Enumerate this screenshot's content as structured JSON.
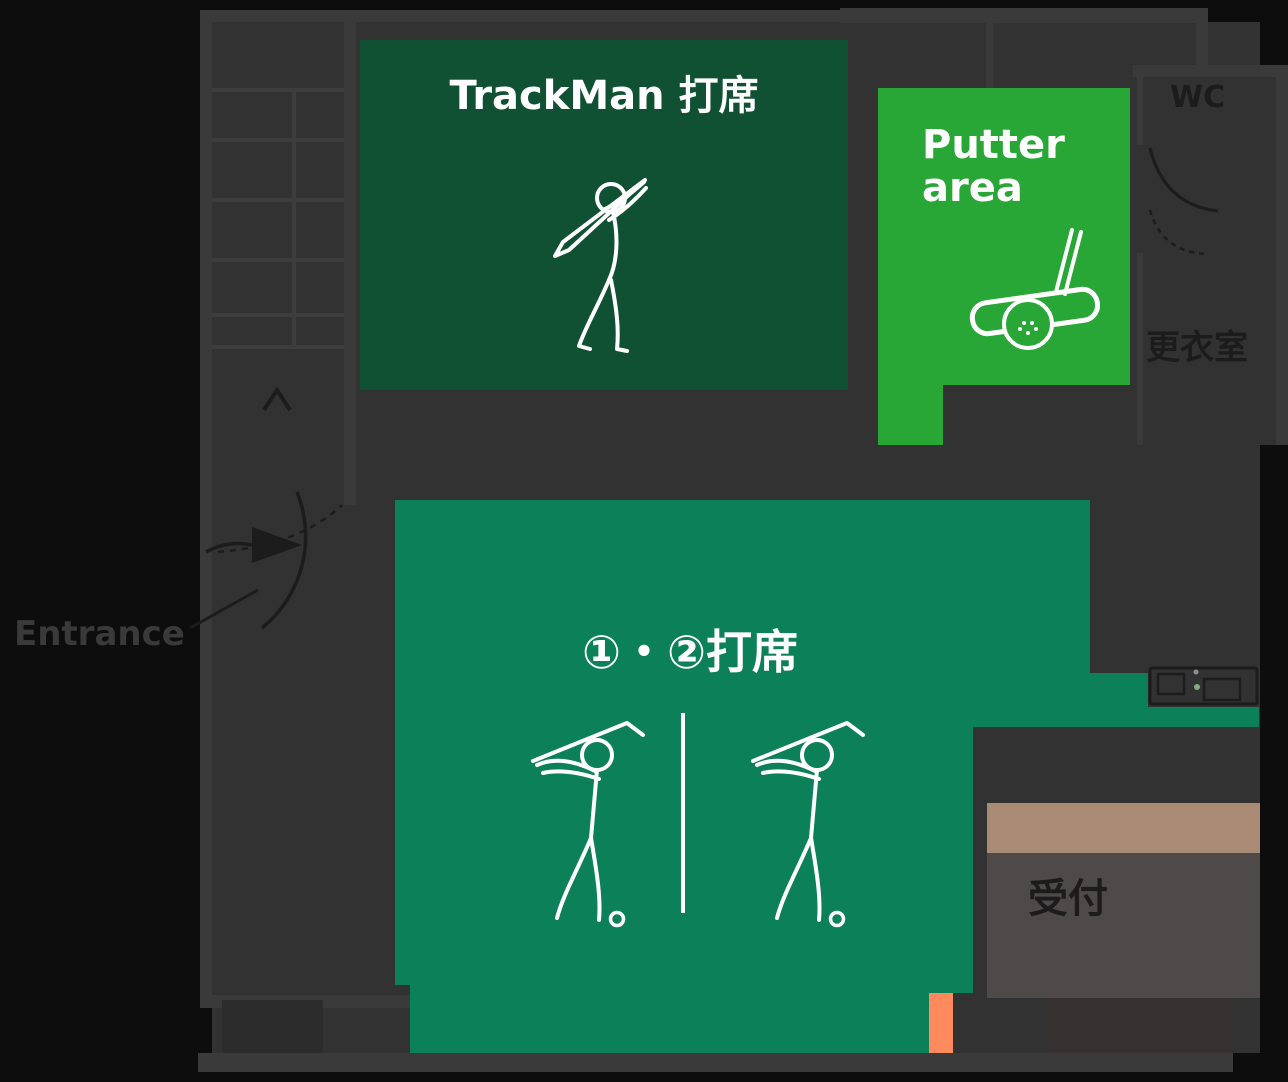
{
  "colors": {
    "outside_bg": "#0d0d0d",
    "interior_bg": "#323232",
    "wall": "#3a3a3a",
    "ink_dark": "#1c1c1c",
    "ink_light": "#3d3d3d",
    "white": "#ffffff",
    "trackman_green": "#0f5132",
    "putter_green": "#28a737",
    "bays_teal": "#0c8159",
    "counter_tan": "#a98a74",
    "reception_floor": "#4f4a4a",
    "orange": "#ff8a5e"
  },
  "rooms": {
    "trackman": {
      "label": "TrackMan 打席"
    },
    "putter": {
      "label_line1": "Putter",
      "label_line2": "area"
    },
    "bays": {
      "label": "①・②打席"
    }
  },
  "labels": {
    "wc": "WC",
    "changing_room": "更衣室",
    "entrance": "Entrance",
    "reception": "受付"
  },
  "icons": {
    "trackman": "golfer-followthrough-icon",
    "bays_left": "golfer-backswing-icon",
    "bays_right": "golfer-backswing-icon",
    "putter": "putter-and-ball-icon",
    "entrance_arrow": "entrance-direction-arrow-icon",
    "up_arrow": "up-direction-arrow-icon",
    "doors": "door-swing-arc",
    "stairs": "staircase"
  }
}
